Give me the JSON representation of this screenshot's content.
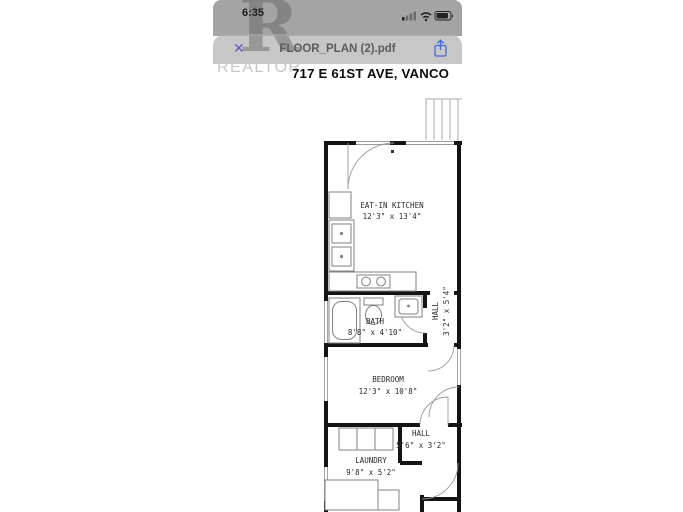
{
  "status_bar": {
    "time": "6:35"
  },
  "toolbar": {
    "title": "FLOOR_PLAN (2).pdf"
  },
  "icons": {
    "close_glyph": "✕",
    "share": "share-up-arrow",
    "cellular": "cellular-signal",
    "wifi": "wifi",
    "battery": "battery"
  },
  "watermark": {
    "logo_letter": "R",
    "brand": "REALTOR"
  },
  "document": {
    "address_heading": "717 E 61ST AVE, VANCO"
  },
  "floor_plan": {
    "rooms": [
      {
        "name": "EAT-IN KITCHEN",
        "dims": "12'3\" x 13'4\""
      },
      {
        "name": "BATH",
        "dims": "8'8\" x 4'10\""
      },
      {
        "name": "HALL",
        "dims": "3'2\" x 5'4\""
      },
      {
        "name": "BEDROOM",
        "dims": "12'3\" x 10'8\""
      },
      {
        "name": "HALL",
        "dims": "5'6\" x 3'2\""
      },
      {
        "name": "LAUNDRY",
        "dims": "9'8\" x 5'2\""
      }
    ]
  }
}
